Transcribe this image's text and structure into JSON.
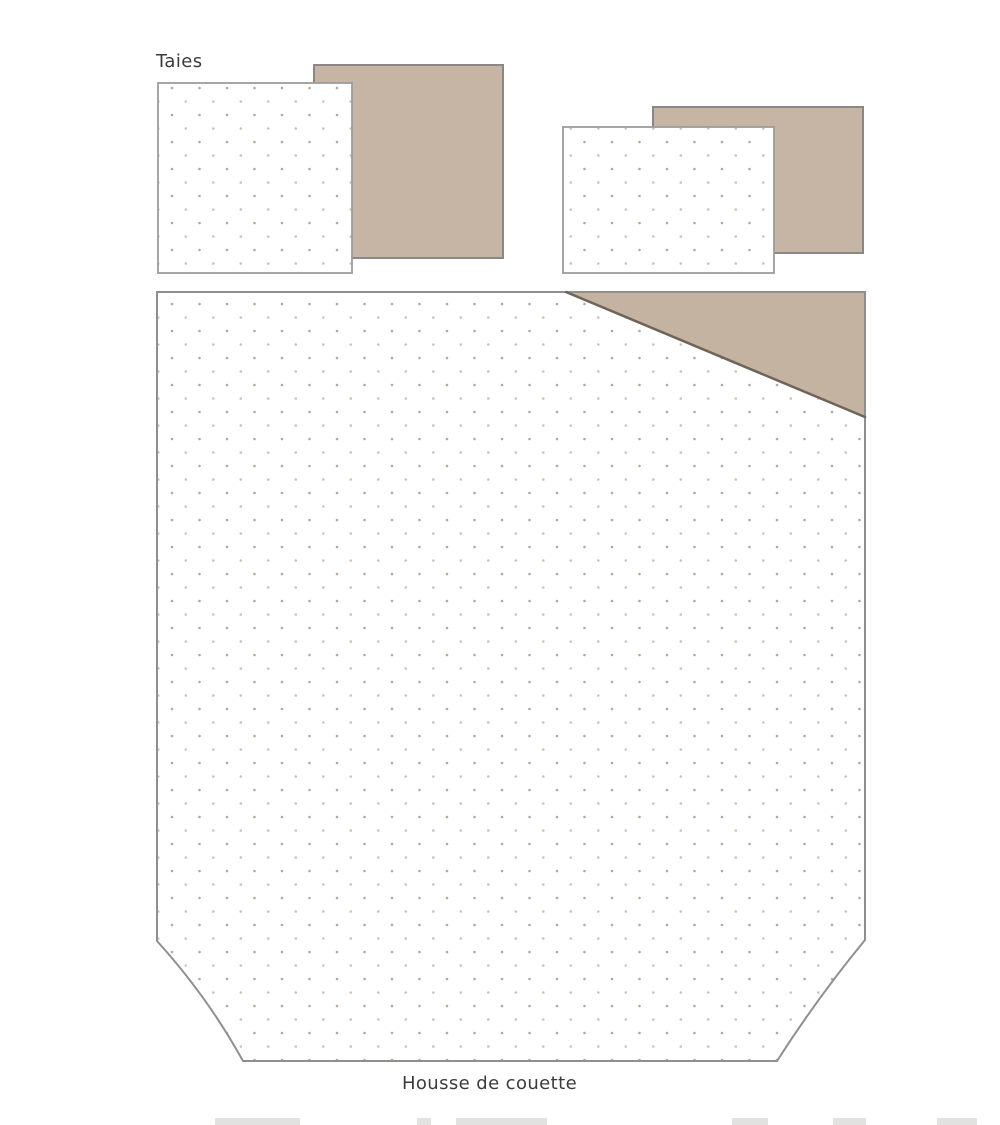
{
  "diagram": {
    "labels": {
      "pillowcases": "Taies",
      "duvet_cover": "Housse de couette"
    },
    "colors": {
      "fabric_back": "#c6b5a4",
      "fold_triangle": "#c5b3a1",
      "fold_edge": "#6f6459",
      "fabric_base": "#ffffff",
      "dot_dark": "#b3a99c",
      "dot_light": "#ccc2b2",
      "label_text": "#3b3b3b"
    }
  }
}
